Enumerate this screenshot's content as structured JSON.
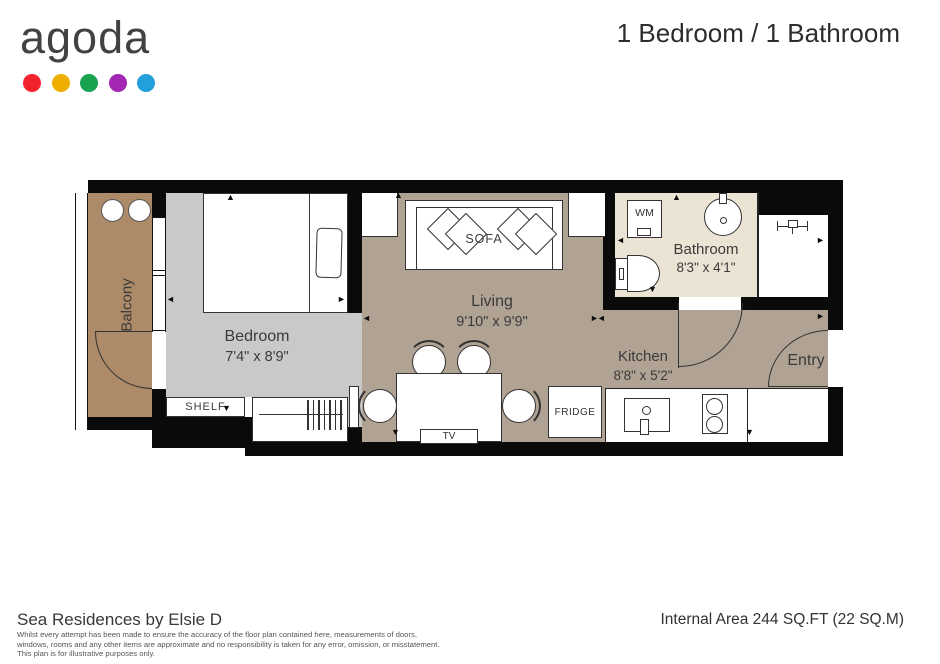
{
  "header": {
    "logo_text": "agoda",
    "logo_dots": [
      "#f2222c",
      "#efae02",
      "#19a34f",
      "#a327b3",
      "#23a0dc"
    ],
    "title": "1 Bedroom / 1 Bathroom"
  },
  "plan": {
    "rooms": {
      "balcony": {
        "name": "Balcony"
      },
      "bedroom": {
        "name": "Bedroom",
        "dims": "7'4\" x 8'9\""
      },
      "living": {
        "name": "Living",
        "dims": "9'10\" x 9'9\""
      },
      "bathroom": {
        "name": "Bathroom",
        "dims": "8'3\" x 4'1\""
      },
      "kitchen": {
        "name": "Kitchen",
        "dims": "8'8\" x 5'2\""
      },
      "entry": {
        "name": "Entry"
      }
    },
    "furniture": {
      "sofa": "SOFA",
      "shelf": "SHELF",
      "tv": "TV",
      "fridge": "FRIDGE",
      "washing_machine": "WM"
    },
    "colors": {
      "wall": "#0a0a0a",
      "balcony": "#ad8a68",
      "bedroom": "#c9c9c9",
      "living": "#b1a393",
      "bathroom": "#ebe3d3"
    }
  },
  "footer": {
    "property": "Sea Residences by Elsie D",
    "disclaimer": [
      "Whilst every attempt has been made to ensure the accuracy of the floor plan contained here, measurements of doors,",
      "windows, rooms and any other items are approximate and no responsibility is taken for any error, omission, or misstatement.",
      "This plan is for illustrative purposes only."
    ],
    "area": "Internal Area 244 SQ.FT (22 SQ.M)"
  }
}
